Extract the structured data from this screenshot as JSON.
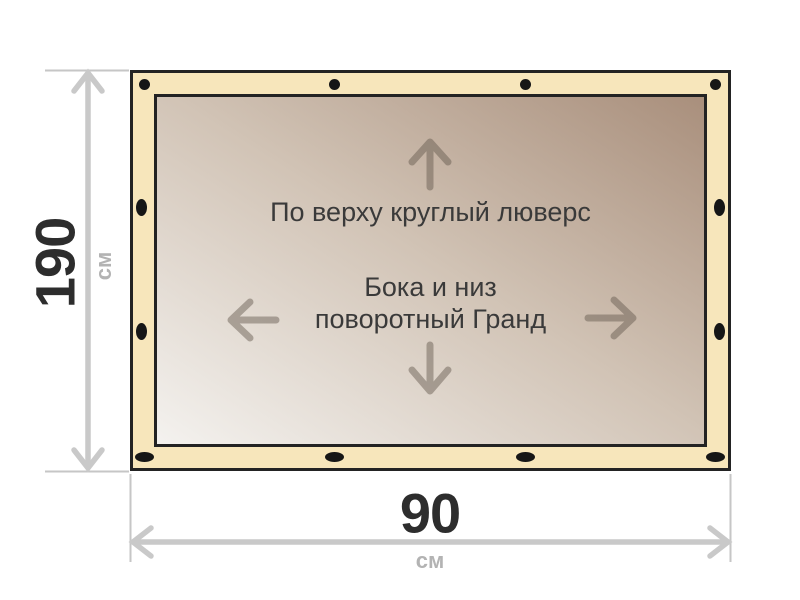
{
  "figure": {
    "type": "banner-grommet-spec-diagram",
    "annotations": {
      "top_note": "По верху круглый люверс",
      "center_note_line1": "Бока и низ",
      "center_note_line2": "поворотный Гранд"
    },
    "dimensions": {
      "height": {
        "value": "190",
        "unit": "см"
      },
      "width": {
        "value": "90",
        "unit": "см"
      }
    },
    "grommets": {
      "top": {
        "shape": "round",
        "count": 4
      },
      "bottom": {
        "shape": "oval",
        "count": 4
      },
      "left": {
        "shape": "oval",
        "count": 2
      },
      "right": {
        "shape": "oval",
        "count": 2
      }
    },
    "colors": {
      "hem_fill": "#f7e6bb",
      "edge_stroke": "#232323",
      "canvas_gradient_light": "#f4f2ef",
      "canvas_gradient_dark": "#a98f7c",
      "direction_arrow": "rgba(95,85,73,0.45)",
      "dimension_line": "#c9c9c9",
      "dimension_value_text": "#2d2d2d",
      "dimension_unit_text": "#b3b3b3",
      "note_text": "#3a3a3a",
      "grommet_fill": "#161616"
    }
  }
}
